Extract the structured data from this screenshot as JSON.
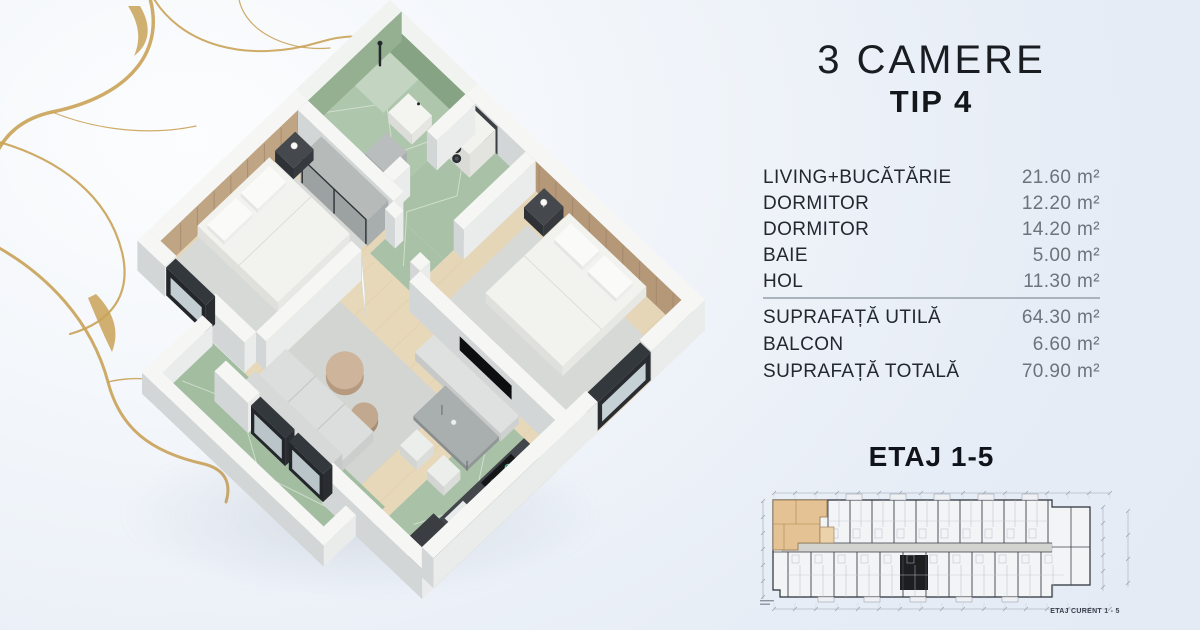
{
  "title": {
    "line1": "3 CAMERE",
    "line2": "TIP 4"
  },
  "rooms": [
    {
      "label": "LIVING+BUCĂTĂRIE",
      "area": "21.60 m²"
    },
    {
      "label": "DORMITOR",
      "area": "12.20 m²"
    },
    {
      "label": "DORMITOR",
      "area": "14.20 m²"
    },
    {
      "label": "BAIE",
      "area": "5.00 m²"
    },
    {
      "label": "HOL",
      "area": "11.30 m²"
    }
  ],
  "totals": [
    {
      "label": "SUPRAFAȚĂ UTILĂ",
      "area": "64.30 m²"
    },
    {
      "label": "BALCON",
      "area": "6.60 m²"
    },
    {
      "label": "SUPRAFAȚĂ TOTALĂ",
      "area": "70.90 m²"
    }
  ],
  "floor_plan": {
    "heading": "ETAJ 1-5",
    "caption": "ETAJ CURENT 1 - 5"
  },
  "palette": {
    "background": "#e8edf6",
    "gold": "#c9a257",
    "text_dark": "#1b1e24",
    "text_muted": "#6d737b",
    "marble_green": "#abc4a9",
    "wood_floor": "#e5d5b7",
    "accent_wall": "#bda183",
    "frame_dark": "#2e3338",
    "highlight_unit": "#e4c294"
  }
}
